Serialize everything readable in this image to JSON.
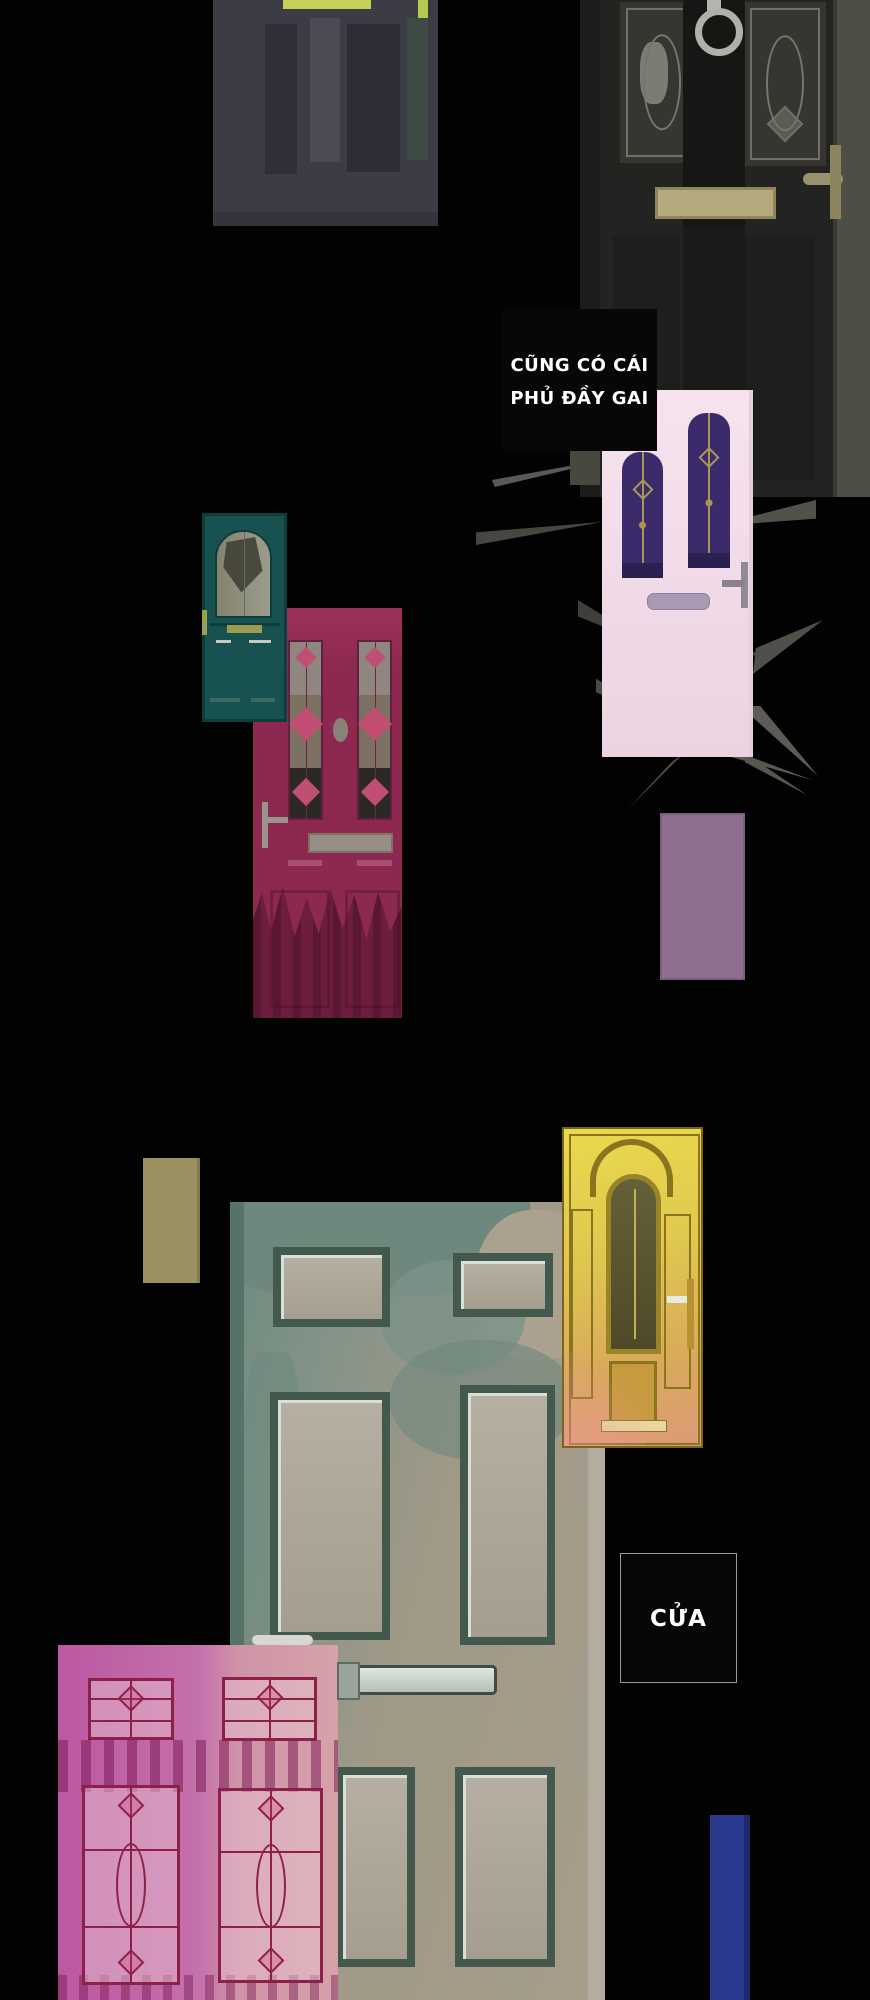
{
  "page": {
    "type": "webtoon-comic-panel",
    "background": "#020202"
  },
  "speech": {
    "box1": {
      "line1": "CŨNG CÓ CÁI",
      "line2": "PHỦ ĐẦY GAI"
    },
    "box2": {
      "line1": "CỬA"
    }
  },
  "doors": [
    {
      "name": "dark-door-with-lit-transom",
      "accent": "#c6d054",
      "base": "#3c3c44"
    },
    {
      "name": "black-victorian-door-with-knocker",
      "base": "#232321",
      "mail_slot": "#b3aa7e",
      "knocker": "#b0b0aa"
    },
    {
      "name": "pink-door-covered-in-thorns",
      "base": "#f4dfeb",
      "glass": "#3c2b6b",
      "thorn_color": "#4a4a46"
    },
    {
      "name": "teal-arched-window-door",
      "base": "#175150",
      "glass": "#8f8f80"
    },
    {
      "name": "crimson-stained-glass-door",
      "base": "#8d2950",
      "diamond": "#c04f73"
    },
    {
      "name": "weathered-teal-panel-door",
      "base_teal": "#6e887d",
      "base_beige": "#a59e8f"
    },
    {
      "name": "ornate-golden-door",
      "base": "#e0c84e",
      "glow_bottom": "#dd9a78"
    },
    {
      "name": "magenta-leaded-glass-door",
      "base": "#c470aa",
      "leadline": "#8c2048"
    }
  ],
  "shapes": [
    {
      "name": "purple-rectangle",
      "color": "#8e6f90"
    },
    {
      "name": "olive-rectangle",
      "color": "#9a9060"
    },
    {
      "name": "blue-rectangle",
      "color": "#2b3a8d"
    }
  ]
}
